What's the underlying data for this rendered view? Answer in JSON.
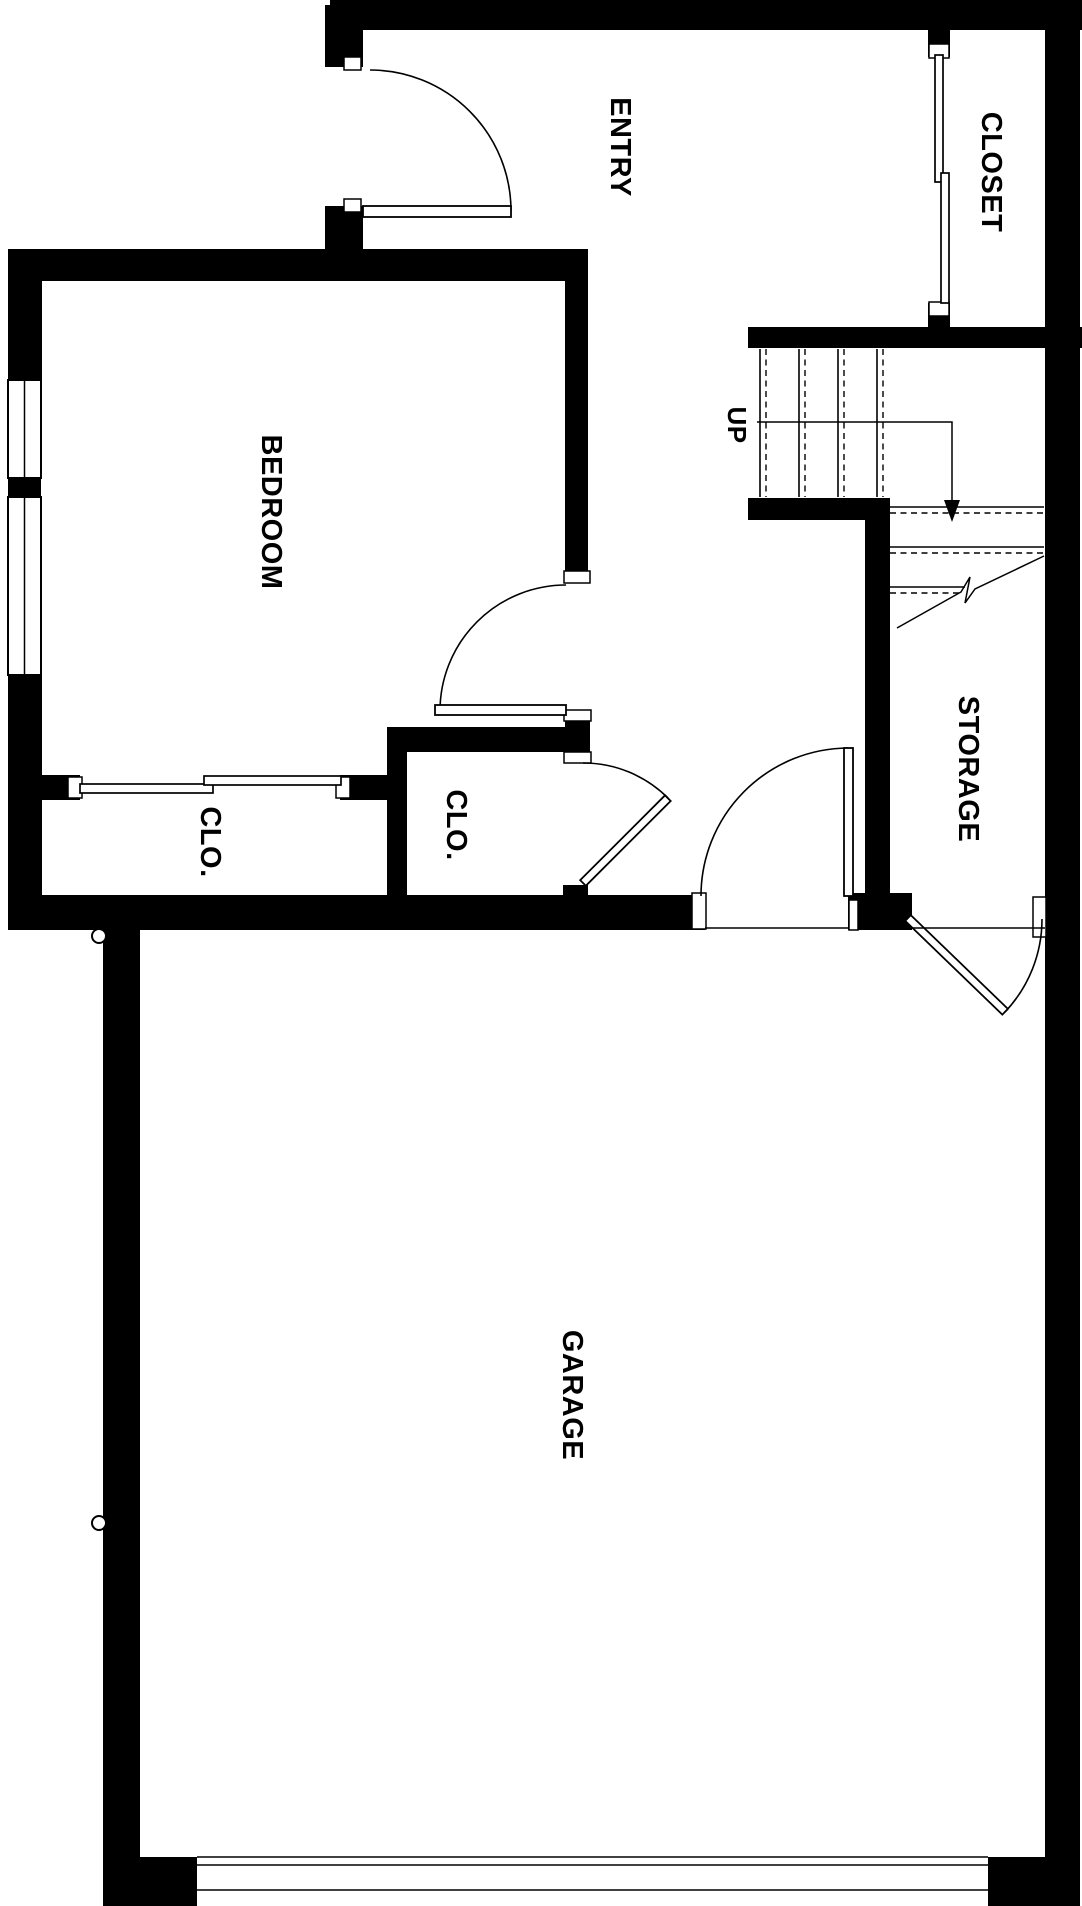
{
  "floor_plan": {
    "background_color": "#ffffff",
    "wall_color": "#000000",
    "line_color": "#000000",
    "labels": {
      "entry": "ENTRY",
      "closet": "CLOSET",
      "bedroom": "BEDROOM",
      "up": "UP",
      "storage": "STORAGE",
      "clo_left": "CLO.",
      "clo_right": "CLO.",
      "garage": "GARAGE"
    }
  }
}
